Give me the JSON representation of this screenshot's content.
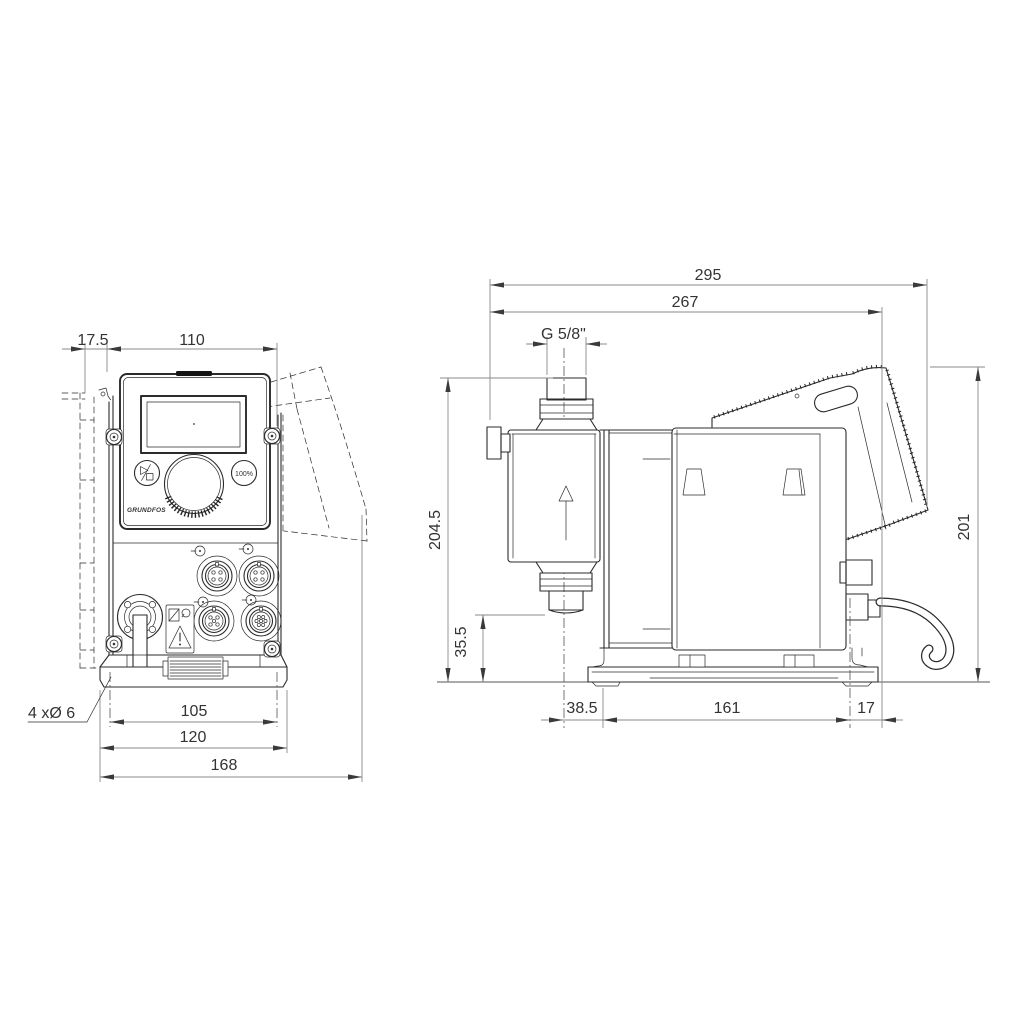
{
  "front_view": {
    "dim_wall_depth": "17.5",
    "dim_body_width": "110",
    "dim_hole_spacing": "105",
    "dim_base_width": "120",
    "dim_overall_width": "168",
    "mounting_holes_label": "4 xØ 6"
  },
  "side_view": {
    "dim_overall_length": "295",
    "dim_length_to_housing_rear": "267",
    "thread_label": "G 5/8\"",
    "dim_height_to_discharge": "204.5",
    "dim_height_to_suction": "35.5",
    "dim_head_center_offset": "38.5",
    "dim_base_length": "161",
    "dim_rear_overhang": "17",
    "dim_overall_height": "201"
  },
  "control_panel": {
    "logo": "GRUNDFOS",
    "capacity_button": "100%"
  }
}
